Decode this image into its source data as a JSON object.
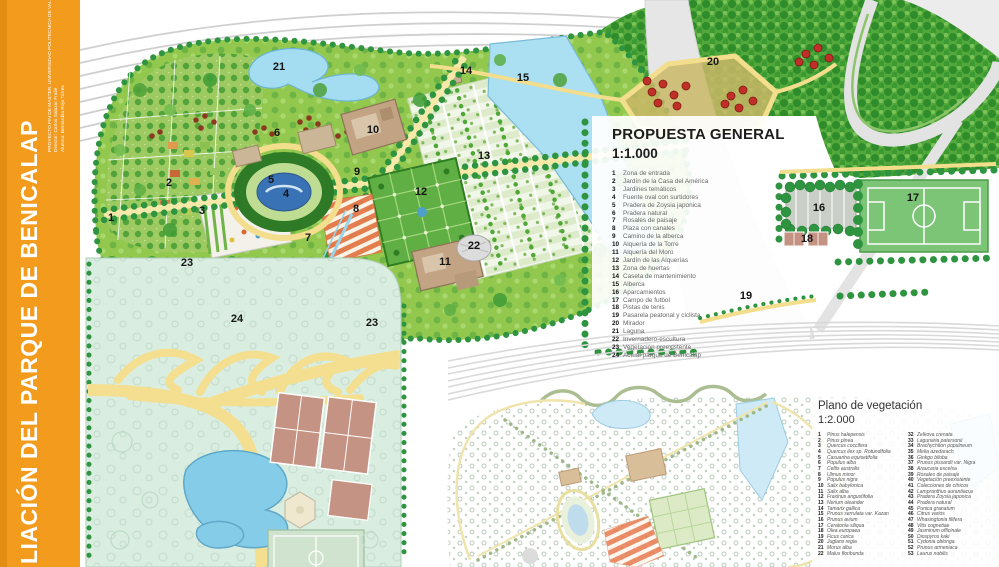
{
  "sidebar": {
    "title": "LIACIÓN DEL PARQUE DE BENICALAP",
    "credits": [
      "PROYECTO FIN DE MASTER. UNIVERSIDAD POLITECNICA DE VALENCIA",
      "Director: Carlos Salazar Fraile",
      "Alumno: Bernardita Rojo Torres"
    ],
    "bg_color": "#F29B1D"
  },
  "legend_propuesta": {
    "title": "PROPUESTA GENERAL",
    "scale": "1:1.000",
    "items": [
      {
        "num": "1",
        "label": "Zona de entrada"
      },
      {
        "num": "2",
        "label": "Jardín de la Casa del América"
      },
      {
        "num": "3",
        "label": "Jardines temáticos"
      },
      {
        "num": "4",
        "label": "Fuente oval con surtidores"
      },
      {
        "num": "5",
        "label": "Pradera de Zoysia japonica"
      },
      {
        "num": "6",
        "label": "Pradera natural"
      },
      {
        "num": "7",
        "label": "Rosales de paisaje"
      },
      {
        "num": "8",
        "label": "Plaza con canales"
      },
      {
        "num": "9",
        "label": "Camino de la alberca"
      },
      {
        "num": "10",
        "label": "Alquería de la Torre"
      },
      {
        "num": "11",
        "label": "Alquería del Moro"
      },
      {
        "num": "12",
        "label": "Jardín de las Alquerías"
      },
      {
        "num": "13",
        "label": "Zona de huertas"
      },
      {
        "num": "14",
        "label": "Caseta de mantenimiento"
      },
      {
        "num": "15",
        "label": "Alberca"
      },
      {
        "num": "16",
        "label": "Aparcamientos"
      },
      {
        "num": "17",
        "label": "Campo de futbol"
      },
      {
        "num": "18",
        "label": "Pistas de tenis"
      },
      {
        "num": "19",
        "label": "Pasarela peatonal y ciclista"
      },
      {
        "num": "20",
        "label": "Mirador"
      },
      {
        "num": "21",
        "label": "Laguna"
      },
      {
        "num": "22",
        "label": "Invernadero-escultura"
      },
      {
        "num": "23",
        "label": "Vegetación preexistente"
      },
      {
        "num": "24",
        "label": "Actual parque de Benicalap"
      }
    ]
  },
  "legend_vegetacion": {
    "title": "Plano de vegetación",
    "scale": "1:2.000",
    "col1": [
      {
        "num": "1",
        "label": "Pinus halepensis"
      },
      {
        "num": "2",
        "label": "Pinus pinea"
      },
      {
        "num": "3",
        "label": "Quercus coccifera"
      },
      {
        "num": "4",
        "label": "Quercus ilex sp. Rotundifolia"
      },
      {
        "num": "5",
        "label": "Casuarina equisetifolia"
      },
      {
        "num": "6",
        "label": "Populus alba"
      },
      {
        "num": "7",
        "label": "Celtis australis"
      },
      {
        "num": "8",
        "label": "Ulmus minor"
      },
      {
        "num": "9",
        "label": "Populus nigra"
      },
      {
        "num": "10",
        "label": "Salix babylonica"
      },
      {
        "num": "11",
        "label": "Salix alba"
      },
      {
        "num": "12",
        "label": "Fraxinus angustifolia"
      },
      {
        "num": "13",
        "label": "Nerium oleander"
      },
      {
        "num": "14",
        "label": "Tamarix gallica"
      },
      {
        "num": "15",
        "label": "Prunus serrulata var. Kazan"
      },
      {
        "num": "16",
        "label": "Prunus avium"
      },
      {
        "num": "17",
        "label": "Ceratonia siliqua"
      },
      {
        "num": "18",
        "label": "Olea europaea"
      },
      {
        "num": "19",
        "label": "Ficus carica"
      },
      {
        "num": "20",
        "label": "Juglans regia"
      },
      {
        "num": "21",
        "label": "Morus alba"
      },
      {
        "num": "22",
        "label": "Malus floribunda"
      }
    ],
    "col2": [
      {
        "num": "32",
        "label": "Zelkova crenata"
      },
      {
        "num": "33",
        "label": "Lagunaria patersonii"
      },
      {
        "num": "34",
        "label": "Brachychiton populneum"
      },
      {
        "num": "35",
        "label": "Melia azedarach"
      },
      {
        "num": "36",
        "label": "Ginkgo biloba"
      },
      {
        "num": "37",
        "label": "Prunus pissardii var. Nigra"
      },
      {
        "num": "38",
        "label": "Araucaria excelsa"
      },
      {
        "num": "39",
        "label": "Rosales de paisaje"
      },
      {
        "num": "40",
        "label": "Vegetación preexistente"
      },
      {
        "num": "41",
        "label": "Colecciones de cítricos"
      },
      {
        "num": "42",
        "label": "Lampranthus aurantiacus"
      },
      {
        "num": "43",
        "label": "Pradera Zoysia japonica"
      },
      {
        "num": "44",
        "label": "Pradera natural"
      },
      {
        "num": "45",
        "label": "Punica granatum"
      },
      {
        "num": "46",
        "label": "Citrus varios"
      },
      {
        "num": "47",
        "label": "Whasingtonia filifera"
      },
      {
        "num": "48",
        "label": "Vitis cognetiae"
      },
      {
        "num": "49",
        "label": "Jasminum officinale"
      },
      {
        "num": "50",
        "label": "Diospyros kaki"
      },
      {
        "num": "51",
        "label": "Cydonia oblonga"
      },
      {
        "num": "52",
        "label": "Prunus armeniaca"
      },
      {
        "num": "53",
        "label": "Laurus nobilis"
      }
    ]
  },
  "map_labels": [
    {
      "num": "1",
      "x": 111,
      "y": 218
    },
    {
      "num": "2",
      "x": 169,
      "y": 183
    },
    {
      "num": "3",
      "x": 202,
      "y": 211
    },
    {
      "num": "4",
      "x": 286,
      "y": 194
    },
    {
      "num": "5",
      "x": 271,
      "y": 180
    },
    {
      "num": "6",
      "x": 277,
      "y": 133
    },
    {
      "num": "7",
      "x": 308,
      "y": 238
    },
    {
      "num": "8",
      "x": 356,
      "y": 209
    },
    {
      "num": "9",
      "x": 357,
      "y": 172
    },
    {
      "num": "10",
      "x": 373,
      "y": 130
    },
    {
      "num": "11",
      "x": 445,
      "y": 262
    },
    {
      "num": "12",
      "x": 421,
      "y": 192
    },
    {
      "num": "13",
      "x": 484,
      "y": 156
    },
    {
      "num": "14",
      "x": 466,
      "y": 71
    },
    {
      "num": "15",
      "x": 523,
      "y": 78
    },
    {
      "num": "16",
      "x": 819,
      "y": 208
    },
    {
      "num": "17",
      "x": 913,
      "y": 198
    },
    {
      "num": "18",
      "x": 807,
      "y": 239
    },
    {
      "num": "19",
      "x": 746,
      "y": 296
    },
    {
      "num": "20",
      "x": 713,
      "y": 62
    },
    {
      "num": "21",
      "x": 279,
      "y": 67
    },
    {
      "num": "22",
      "x": 474,
      "y": 246
    },
    {
      "num": "23",
      "x": 187,
      "y": 263
    },
    {
      "num": "23",
      "x": 372,
      "y": 323
    },
    {
      "num": "24",
      "x": 237,
      "y": 319
    }
  ],
  "colors": {
    "sidebar_orange": "#F29B1D",
    "meadow_green": "#93C84F",
    "forest_green": "#2E8C2B",
    "water_blue": "#A4DDF1",
    "path_yellow": "#F2DE8C",
    "building_tan": "#C2A384",
    "rosales_orange": "#E87A4E"
  }
}
